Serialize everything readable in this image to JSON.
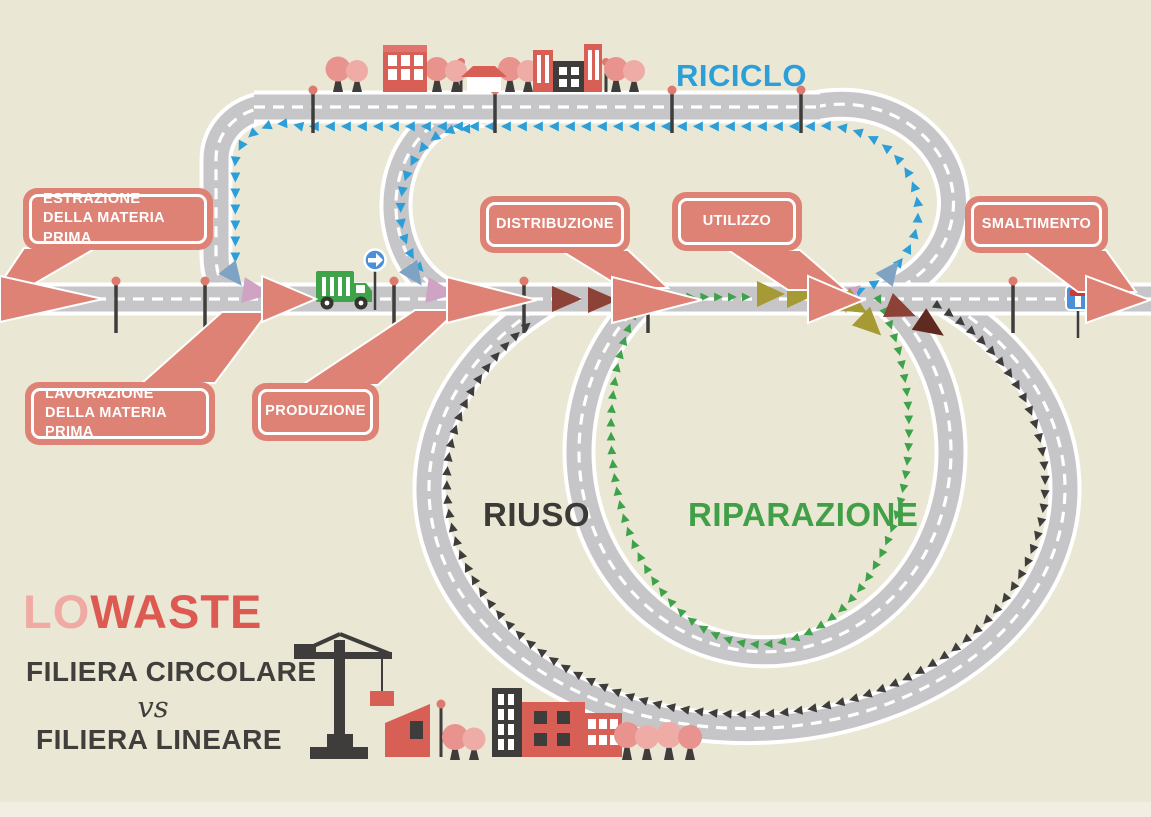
{
  "scene": {
    "background_color": "#eae7d5",
    "footer_strip_color": "#f2efe2",
    "road_color": "#c6c5c8",
    "accent_salmon": "#df8276",
    "riciclo_blue": "#2d9fd8",
    "riparazione_green": "#3ea24b",
    "riuso_dark": "#3e3d3b",
    "olive": "#a59a33",
    "wine_red": "#8c4236",
    "mauve": "#cfa3c4",
    "steel_blue": "#7fa3c2",
    "building_red": "#d85f56",
    "tree_pink": "#e8938d",
    "truck_green": "#3fa34a",
    "sign_blue": "#4a90d9"
  },
  "loops": {
    "riciclo_label": "RICICLO",
    "riuso_label": "RIUSO",
    "riparazione_label": "RIPARAZIONE"
  },
  "callouts": {
    "estrazione": {
      "label": "ESTRAZIONE\nDELLA MATERIA PRIMA"
    },
    "lavorazione": {
      "label": "LAVORAZIONE\nDELLA MATERIA PRIMA"
    },
    "produzione": {
      "label": "PRODUZIONE"
    },
    "distribuzione": {
      "label": "DISTRIBUZIONE"
    },
    "utilizzo": {
      "label": "UTILIZZO"
    },
    "smaltimento": {
      "label": "SMALTIMENTO"
    }
  },
  "footer": {
    "brand_lo": "LO",
    "brand_waste": "WASTE",
    "line1": "FILIERA CIRCOLARE",
    "vs": "vs",
    "line2": "FILIERA LINEARE"
  },
  "icons": [
    "garbage-truck-icon",
    "one-way-sign-icon",
    "dead-end-sign-icon",
    "street-lamp-icon",
    "tree-icon",
    "building-icon",
    "house-icon",
    "crane-icon"
  ],
  "arrow_chains": [
    {
      "path_id": "chain-riciclo-main",
      "glyph": "▶",
      "color": "#2d9fd8",
      "font_size": 13,
      "letter_spacing": 6,
      "count": 60
    },
    {
      "path_id": "chain-riciclo-branch",
      "glyph": "▶",
      "color": "#2d9fd8",
      "font_size": 13,
      "letter_spacing": 6,
      "count": 14
    },
    {
      "path_id": "chain-riparazione",
      "glyph": "▶",
      "color": "#3ea24b",
      "font_size": 11.5,
      "letter_spacing": 5,
      "count": 70
    },
    {
      "path_id": "chain-riuso",
      "glyph": "▶",
      "color": "#3e3d3b",
      "font_size": 12,
      "letter_spacing": 5,
      "count": 88
    }
  ]
}
